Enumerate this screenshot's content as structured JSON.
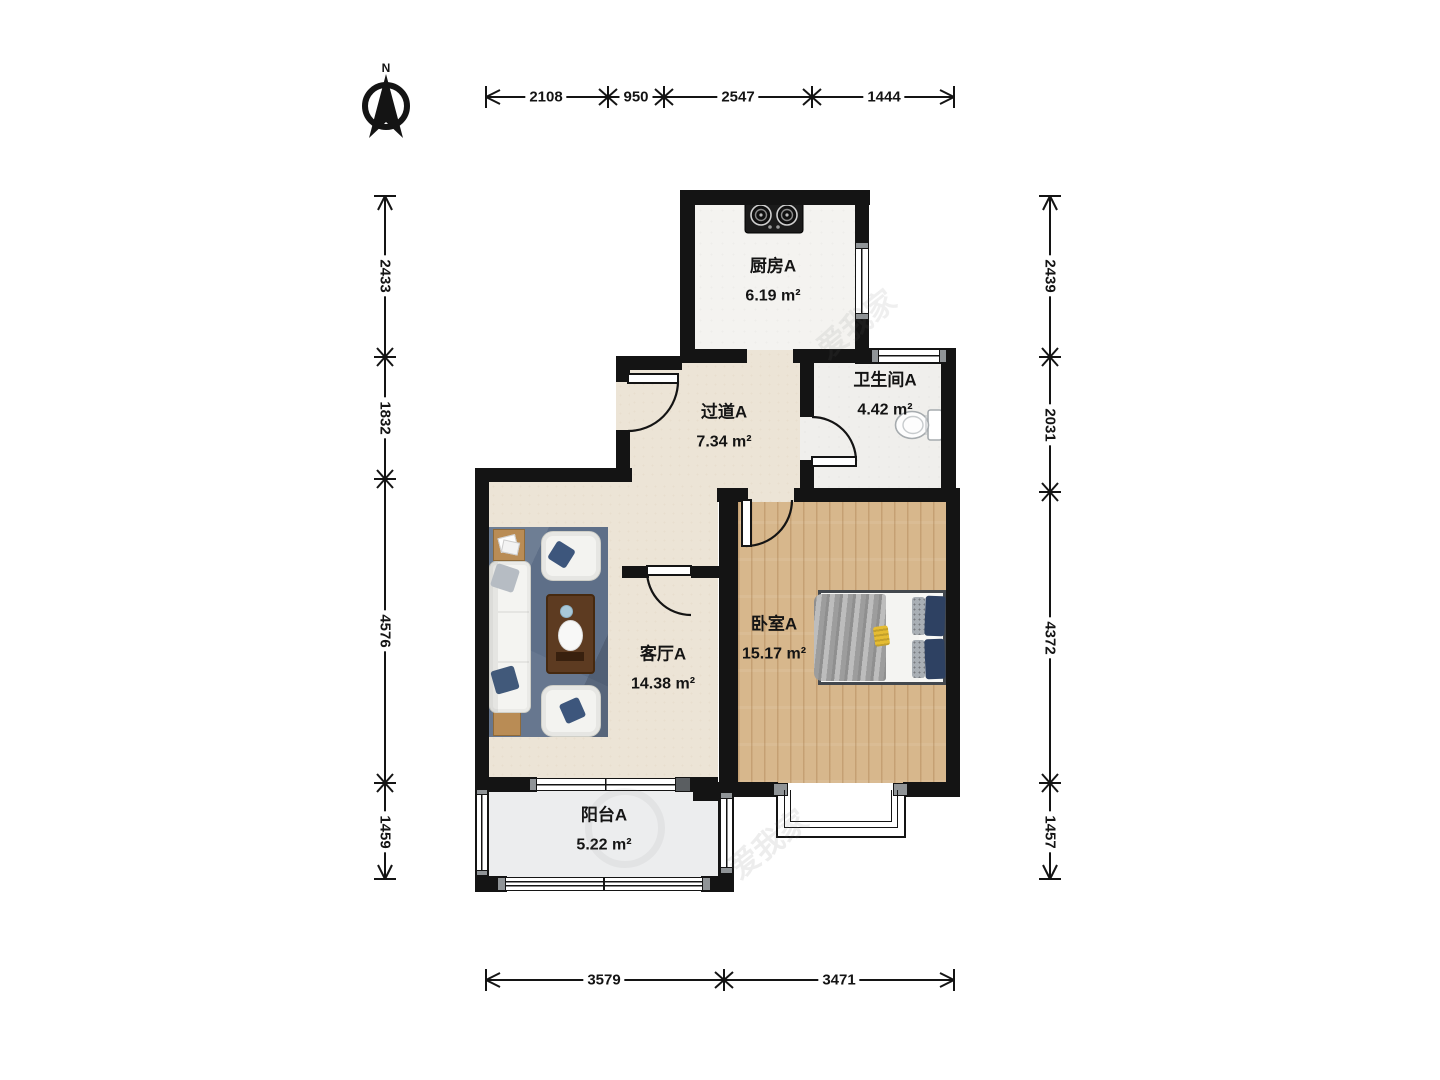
{
  "compass": {
    "label": "N"
  },
  "rooms": [
    {
      "id": "kitchen",
      "name": "厨房A",
      "area": "6.19 m²"
    },
    {
      "id": "hallway",
      "name": "过道A",
      "area": "7.34 m²"
    },
    {
      "id": "bathroom",
      "name": "卫生间A",
      "area": "4.42 m²"
    },
    {
      "id": "living-room",
      "name": "客厅A",
      "area": "14.38 m²"
    },
    {
      "id": "bedroom",
      "name": "卧室A",
      "area": "15.17 m²"
    },
    {
      "id": "balcony",
      "name": "阳台A",
      "area": "5.22 m²"
    }
  ],
  "dimensions": {
    "top": {
      "orientation": "horizontal",
      "segments": [
        "2108",
        "950",
        "2547",
        "1444"
      ]
    },
    "left": {
      "orientation": "vertical",
      "segments": [
        "2433",
        "1832",
        "4576",
        "1459"
      ]
    },
    "right": {
      "orientation": "vertical",
      "segments": [
        "2439",
        "2031",
        "4372",
        "1457"
      ]
    },
    "bottom": {
      "orientation": "horizontal",
      "segments": [
        "3579",
        "3471"
      ]
    }
  },
  "watermark": {
    "text": "爱我家"
  },
  "colors": {
    "wall": "#141414",
    "wood_floor": "#d7b78c",
    "tile_floor": "#f4f3f0",
    "beige_floor": "#ece4d6",
    "balcony_floor": "#ecedee",
    "rug": "#5e6f88",
    "pillow_navy": "#2e4162"
  }
}
